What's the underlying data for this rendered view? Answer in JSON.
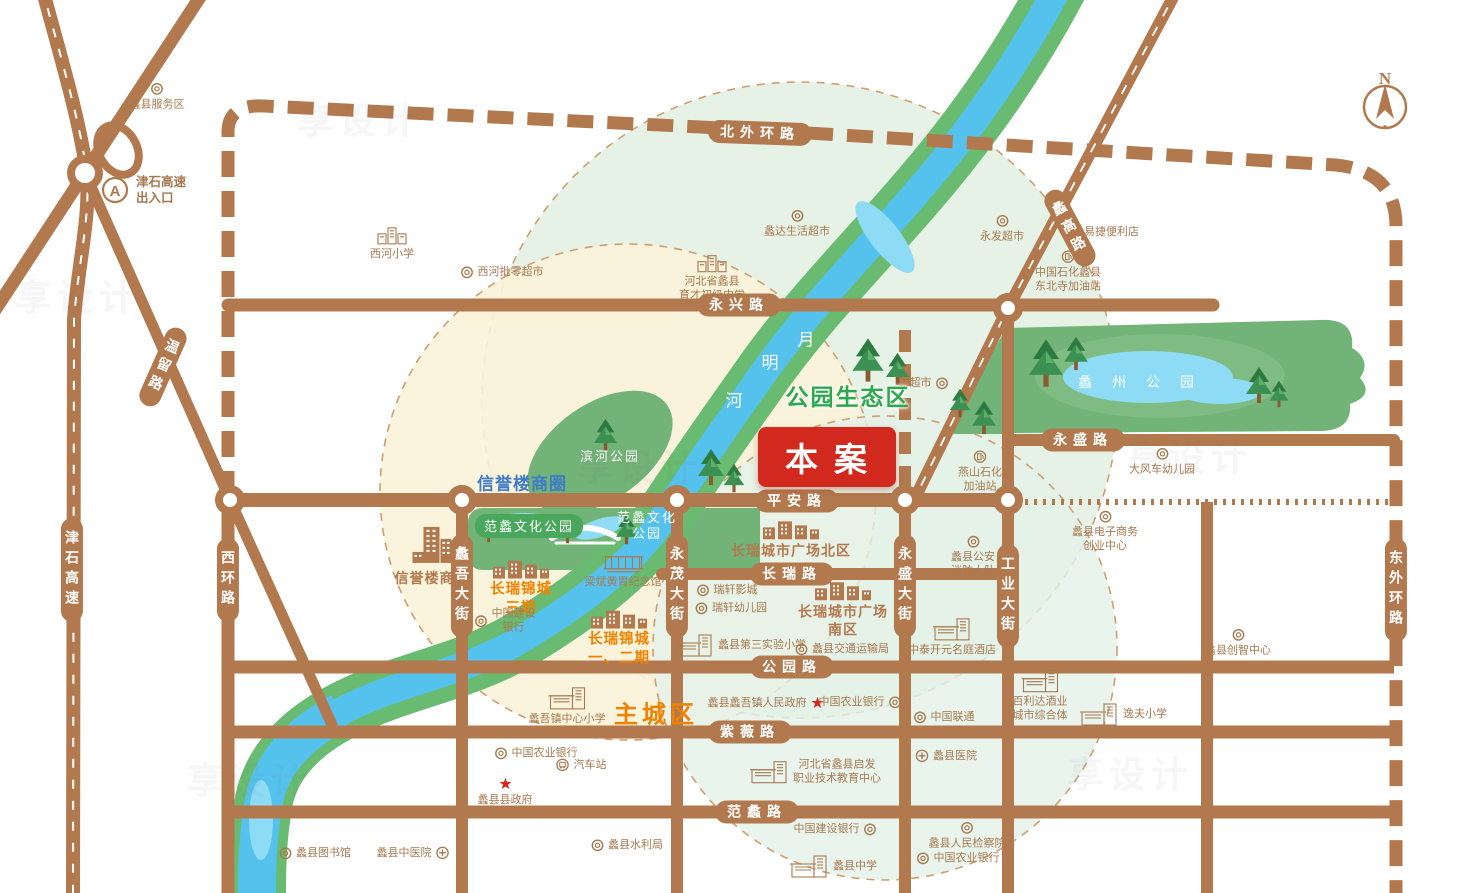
{
  "map": {
    "site_badge": "本案",
    "compass_label": "N",
    "watermark_text": "享设计",
    "colors": {
      "road": "#b3794e",
      "river_green": "#68bb70",
      "river_blue": "#55c2ee",
      "lake_light": "#8edbf5",
      "park_green": "#72b377",
      "badge_red": "#d2291e",
      "orange_text": "#f08200",
      "blue_text": "#3f7cc8",
      "green_text": "#2ea84e",
      "poi_text": "#a87950"
    },
    "road_labels": [
      {
        "text": "北外环路",
        "x": 760,
        "y": 133,
        "o": "h",
        "rot": 2
      },
      {
        "text": "永兴路",
        "x": 739,
        "y": 305,
        "o": "h"
      },
      {
        "text": "永盛路",
        "x": 1083,
        "y": 440,
        "o": "h"
      },
      {
        "text": "平安路",
        "x": 797,
        "y": 501,
        "o": "h"
      },
      {
        "text": "长瑞路",
        "x": 792,
        "y": 574,
        "o": "h"
      },
      {
        "text": "公园路",
        "x": 792,
        "y": 667,
        "o": "h"
      },
      {
        "text": "紫薇路",
        "x": 750,
        "y": 732,
        "o": "h"
      },
      {
        "text": "范蠡路",
        "x": 757,
        "y": 812,
        "o": "h"
      },
      {
        "text": "津石高速",
        "x": 72,
        "y": 570,
        "o": "v"
      },
      {
        "text": "温留路",
        "x": 163,
        "y": 367,
        "o": "v",
        "rot": 24
      },
      {
        "text": "西环路",
        "x": 228,
        "y": 580,
        "o": "v"
      },
      {
        "text": "蠡吾大街",
        "x": 462,
        "y": 586,
        "o": "v"
      },
      {
        "text": "永茂大街",
        "x": 677,
        "y": 586,
        "o": "v"
      },
      {
        "text": "永盛大街",
        "x": 905,
        "y": 586,
        "o": "v"
      },
      {
        "text": "工业大街",
        "x": 1008,
        "y": 596,
        "o": "v"
      },
      {
        "text": "东外环路",
        "x": 1396,
        "y": 590,
        "o": "v"
      },
      {
        "text": "蠡高路",
        "x": 1070,
        "y": 228,
        "o": "v",
        "rot": -28
      }
    ],
    "area_labels": [
      {
        "text": "公园生态区",
        "x": 848,
        "y": 395,
        "cls": "area-green"
      },
      {
        "text": "主城区",
        "x": 656,
        "y": 712,
        "cls": "area-orange"
      },
      {
        "text": "信誉楼商圈",
        "x": 522,
        "y": 482,
        "cls": "area-blue"
      },
      {
        "text": "蠡 州 公 园",
        "x": 1140,
        "y": 382,
        "cls": "park-name"
      },
      {
        "text": "滨河公园",
        "x": 610,
        "y": 457,
        "cls": "park-sm"
      },
      {
        "text": "范蠡文化公园",
        "x": 529,
        "y": 526,
        "cls": "park-chip"
      },
      {
        "lines": [
          "范蠡文化",
          "公园"
        ],
        "x": 647,
        "y": 526,
        "cls": "park-sm"
      }
    ],
    "river_name_chars": [
      {
        "ch": "月",
        "x": 806,
        "y": 338
      },
      {
        "ch": "明",
        "x": 770,
        "y": 361
      },
      {
        "ch": "河",
        "x": 734,
        "y": 399
      }
    ],
    "pois": [
      {
        "text": "蠡县服务区",
        "x": 157,
        "y": 97,
        "icon": "ring",
        "layout": "top"
      },
      {
        "lines": [
          "津石高速",
          "出入口"
        ],
        "x": 158,
        "y": 190,
        "icon": "A",
        "layout": "left",
        "cls": "poi-bold"
      },
      {
        "text": "西河小学",
        "x": 392,
        "y": 243,
        "icon": "bldg",
        "layout": "top"
      },
      {
        "text": "西河批零超市",
        "x": 502,
        "y": 272,
        "icon": "ring",
        "layout": "left"
      },
      {
        "lines": [
          "河北省蠡县",
          "育才初级中学"
        ],
        "x": 712,
        "y": 278,
        "icon": "bldg",
        "layout": "top"
      },
      {
        "text": "蠡达生活超市",
        "x": 797,
        "y": 224,
        "icon": "ring",
        "layout": "top"
      },
      {
        "text": "永发超市",
        "x": 1002,
        "y": 229,
        "icon": "ring",
        "layout": "top"
      },
      {
        "text": "易捷便利店",
        "x": 1103,
        "y": 232,
        "icon": "ring",
        "layout": "left"
      },
      {
        "lines": [
          "中国石化蠡县",
          "东北寺加油站"
        ],
        "x": 1068,
        "y": 272,
        "icon": "gas",
        "layout": "top"
      },
      {
        "text": "超市",
        "x": 929,
        "y": 383,
        "icon": "ring",
        "layout": "right"
      },
      {
        "lines": [
          "燕山石化",
          "加油站"
        ],
        "x": 980,
        "y": 472,
        "icon": "gas",
        "layout": "top"
      },
      {
        "text": "大风车幼儿园",
        "x": 1162,
        "y": 462,
        "icon": "ring",
        "layout": "top"
      },
      {
        "lines": [
          "蠡县电子商务",
          "创业中心"
        ],
        "x": 1105,
        "y": 532,
        "icon": "ring",
        "layout": "top"
      },
      {
        "lines": [
          "蠡县公安",
          "消防大队"
        ],
        "x": 973,
        "y": 557,
        "icon": "ring",
        "layout": "top"
      },
      {
        "text": "中泰开元名庭酒店",
        "x": 952,
        "y": 637,
        "icon": "bldg2",
        "layout": "top"
      },
      {
        "text": "梁斌黄胄纪念馆",
        "x": 623,
        "y": 571,
        "icon": "hall",
        "layout": "top"
      },
      {
        "text": "信誉楼商厦",
        "x": 432,
        "y": 556,
        "icon": "tower",
        "layout": "top",
        "cls": "brown-bold"
      },
      {
        "lines": [
          "长瑞锦城",
          "三期"
        ],
        "x": 521,
        "y": 589,
        "icon": "bldgrow",
        "layout": "top",
        "cls": "orange"
      },
      {
        "lines": [
          "中国建设",
          "银行"
        ],
        "x": 505,
        "y": 621,
        "icon": "ring",
        "layout": "left"
      },
      {
        "lines": [
          "长瑞锦城",
          "一、二期"
        ],
        "x": 619,
        "y": 639,
        "icon": "bldgrow",
        "layout": "top",
        "cls": "orange"
      },
      {
        "text": "长瑞城市广场北区",
        "x": 791,
        "y": 540,
        "icon": "bldgrow",
        "layout": "top",
        "cls": "brown-bold"
      },
      {
        "text": "瑞轩影城",
        "x": 727,
        "y": 590,
        "icon": "ring",
        "layout": "left"
      },
      {
        "text": "瑞轩幼儿园",
        "x": 731,
        "y": 608,
        "icon": "ring",
        "layout": "left"
      },
      {
        "lines": [
          "长瑞城市广场",
          "南区"
        ],
        "x": 843,
        "y": 610,
        "icon": "bldgrow",
        "layout": "top",
        "cls": "brown-bold"
      },
      {
        "text": "蠡县第三实验小学",
        "x": 740,
        "y": 645,
        "icon": "bldg2",
        "layout": "left"
      },
      {
        "text": "蠡县交通运输局",
        "x": 842,
        "y": 649,
        "icon": "ring",
        "layout": "left"
      },
      {
        "text": "蠡吾镇中心小学",
        "x": 567,
        "y": 706,
        "icon": "bldg2",
        "layout": "top"
      },
      {
        "text": "蠡县蠡吾镇人民政府",
        "x": 766,
        "y": 703,
        "icon": "star",
        "layout": "right"
      },
      {
        "text": "中国农业银行",
        "x": 860,
        "y": 702,
        "icon": "ring",
        "layout": "right"
      },
      {
        "text": "中国联通",
        "x": 944,
        "y": 717,
        "icon": "ring",
        "layout": "left"
      },
      {
        "text": "蠡县医院",
        "x": 946,
        "y": 756,
        "icon": "hosp",
        "layout": "left"
      },
      {
        "lines": [
          "百利达酒业",
          "城市综合体"
        ],
        "x": 1040,
        "y": 696,
        "icon": "bldg2",
        "layout": "top"
      },
      {
        "text": "逸夫小学",
        "x": 1123,
        "y": 714,
        "icon": "bldg2",
        "layout": "left"
      },
      {
        "text": "蠡县创智中心",
        "x": 1238,
        "y": 643,
        "icon": "ring",
        "layout": "top"
      },
      {
        "lines": [
          "河北省蠡县启发",
          "职业技术教育中心"
        ],
        "x": 815,
        "y": 772,
        "icon": "bldg2",
        "layout": "left"
      },
      {
        "text": "蠡县县政府",
        "x": 505,
        "y": 792,
        "icon": "star",
        "layout": "top"
      },
      {
        "text": "中国农业银行",
        "x": 536,
        "y": 753,
        "icon": "ring",
        "layout": "left"
      },
      {
        "text": "汽车站",
        "x": 581,
        "y": 765,
        "icon": "bus",
        "layout": "left"
      },
      {
        "text": "蠡县图书馆",
        "x": 315,
        "y": 853,
        "icon": "ring",
        "layout": "left"
      },
      {
        "text": "蠡县中医院",
        "x": 413,
        "y": 853,
        "icon": "hosp",
        "layout": "right"
      },
      {
        "text": "蠡县水利局",
        "x": 627,
        "y": 845,
        "icon": "ring",
        "layout": "left"
      },
      {
        "text": "蠡县中学",
        "x": 833,
        "y": 866,
        "icon": "bldg2",
        "layout": "left"
      },
      {
        "text": "中国建设银行",
        "x": 835,
        "y": 829,
        "icon": "ring",
        "layout": "right"
      },
      {
        "text": "蠡县人民检察院",
        "x": 967,
        "y": 836,
        "icon": "ring",
        "layout": "top"
      },
      {
        "text": "中国农业银行",
        "x": 958,
        "y": 858,
        "icon": "ring",
        "layout": "left"
      }
    ]
  }
}
